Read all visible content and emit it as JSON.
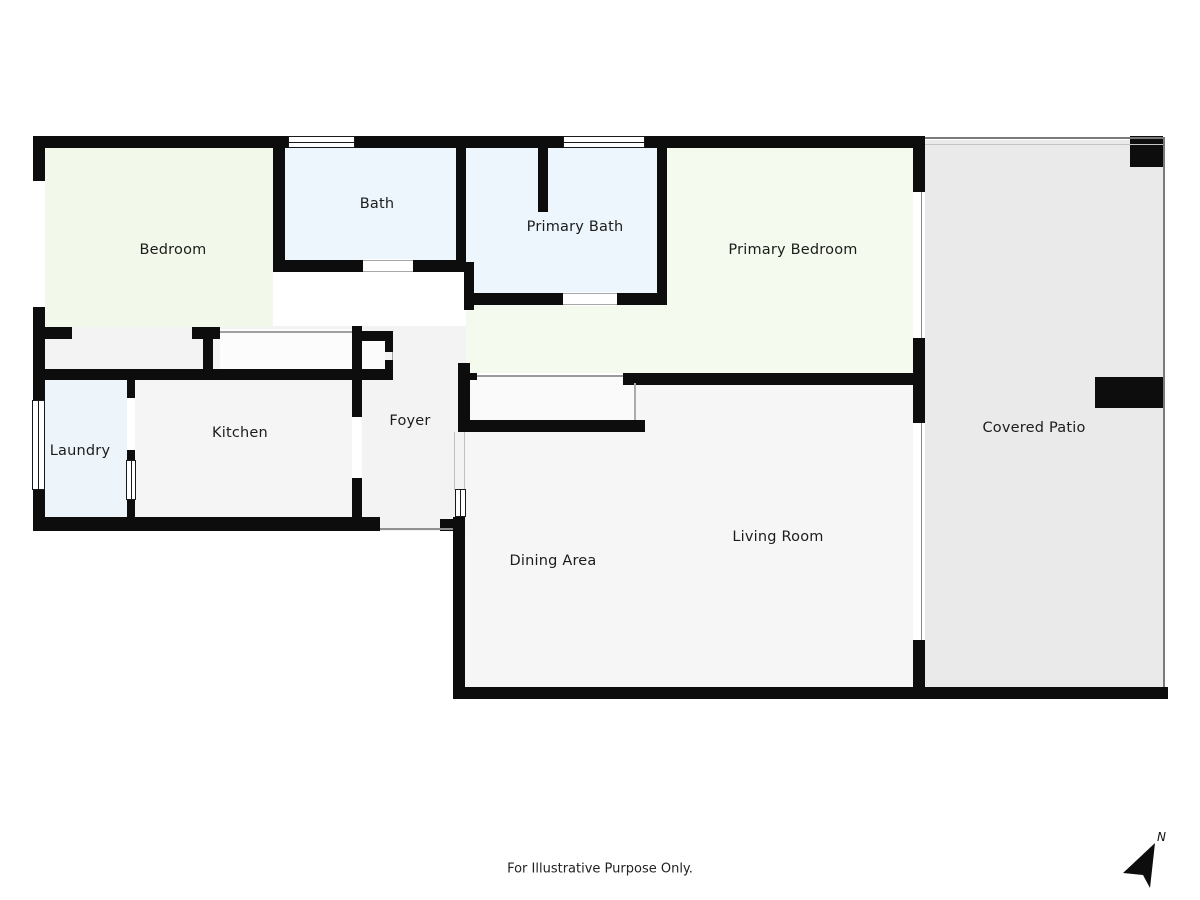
{
  "disclaimer": "For Illustrative Purpose Only.",
  "compass": {
    "label": "N"
  },
  "colors": {
    "wall": "#0d0d0d",
    "background": "#ffffff",
    "patio": "#eaeaea",
    "living_area": "#f6f6f6",
    "hall": "#f3f3f3",
    "kitchen": "#f5f5f5",
    "wet_room_blue": "#edf6fc",
    "bedroom_green": "#f4faee",
    "label_text": "#1c1c1c"
  },
  "rooms": [
    {
      "id": "bedroom",
      "label": "Bedroom",
      "x": 173,
      "y": 250
    },
    {
      "id": "bath",
      "label": "Bath",
      "x": 377,
      "y": 204
    },
    {
      "id": "primary-bath",
      "label": "Primary Bath",
      "x": 575,
      "y": 227
    },
    {
      "id": "primary-bedroom",
      "label": "Primary Bedroom",
      "x": 793,
      "y": 250
    },
    {
      "id": "covered-patio",
      "label": "Covered Patio",
      "x": 1034,
      "y": 428
    },
    {
      "id": "laundry",
      "label": "Laundry",
      "x": 80,
      "y": 451
    },
    {
      "id": "kitchen",
      "label": "Kitchen",
      "x": 240,
      "y": 433
    },
    {
      "id": "foyer",
      "label": "Foyer",
      "x": 410,
      "y": 421
    },
    {
      "id": "dining-area",
      "label": "Dining Area",
      "x": 553,
      "y": 561
    },
    {
      "id": "living-room",
      "label": "Living Room",
      "x": 778,
      "y": 537
    }
  ],
  "fills": [
    {
      "n": "room-fill-covered-patio",
      "x": 925,
      "y": 140,
      "w": 238,
      "h": 547,
      "c": "#eaeaea"
    },
    {
      "n": "room-fill-living-dining",
      "x": 456,
      "y": 383,
      "w": 457,
      "h": 304,
      "c": "#f6f6f6"
    },
    {
      "n": "room-fill-hallway",
      "x": 45,
      "y": 326,
      "w": 421,
      "h": 54,
      "c": "#f3f3f3"
    },
    {
      "n": "room-fill-foyer",
      "x": 362,
      "y": 380,
      "w": 104,
      "h": 151,
      "c": "#f3f3f3"
    },
    {
      "n": "room-fill-kitchen",
      "x": 135,
      "y": 380,
      "w": 217,
      "h": 137,
      "c": "#f5f5f5"
    },
    {
      "n": "room-fill-laundry",
      "x": 45,
      "y": 380,
      "w": 82,
      "h": 137,
      "c": "#edf5fa"
    },
    {
      "n": "room-fill-bedroom",
      "x": 45,
      "y": 148,
      "w": 228,
      "h": 179,
      "c": "#f3f9ea"
    },
    {
      "n": "room-fill-bath",
      "x": 285,
      "y": 148,
      "w": 171,
      "h": 112,
      "c": "#edf6fc"
    },
    {
      "n": "room-fill-primary-bath",
      "x": 466,
      "y": 148,
      "w": 191,
      "h": 145,
      "c": "#edf6fc"
    },
    {
      "n": "room-fill-primary-bedroom",
      "x": 667,
      "y": 148,
      "w": 246,
      "h": 225,
      "c": "#f4faee"
    },
    {
      "n": "room-fill-primary-corridor",
      "x": 466,
      "y": 305,
      "w": 201,
      "h": 68,
      "c": "#f4faee"
    },
    {
      "n": "closet-fill-bedroom",
      "x": 220,
      "y": 329,
      "w": 132,
      "h": 40,
      "c": "#fcfcfc"
    },
    {
      "n": "closet-fill-linen",
      "x": 362,
      "y": 341,
      "w": 23,
      "h": 28,
      "c": "#fbfbfb"
    },
    {
      "n": "closet-fill-entry-nook",
      "x": 470,
      "y": 377,
      "w": 165,
      "h": 43,
      "c": "#fafafa"
    }
  ],
  "walls": [
    {
      "n": "exterior-top-wall",
      "x": 33,
      "y": 136,
      "w": 892,
      "h": 12
    },
    {
      "n": "exterior-left-wall-upper",
      "x": 33,
      "y": 136,
      "w": 12,
      "h": 45
    },
    {
      "n": "exterior-left-wall-mid",
      "x": 33,
      "y": 307,
      "w": 12,
      "h": 93
    },
    {
      "n": "exterior-left-wall-lower",
      "x": 33,
      "y": 490,
      "w": 12,
      "h": 41
    },
    {
      "n": "exterior-bottom-left-wall",
      "x": 33,
      "y": 517,
      "w": 347,
      "h": 14
    },
    {
      "n": "dining-left-wall",
      "x": 453,
      "y": 517,
      "w": 12,
      "h": 182
    },
    {
      "n": "dining-left-corner",
      "x": 440,
      "y": 519,
      "w": 14,
      "h": 12
    },
    {
      "n": "exterior-bottom-wall",
      "x": 453,
      "y": 687,
      "w": 715,
      "h": 12
    },
    {
      "n": "bedroom-bath-wall",
      "x": 273,
      "y": 148,
      "w": 12,
      "h": 124
    },
    {
      "n": "bath-south-wall-left",
      "x": 273,
      "y": 260,
      "w": 90,
      "h": 12
    },
    {
      "n": "bath-south-wall-right",
      "x": 413,
      "y": 260,
      "w": 53,
      "h": 12
    },
    {
      "n": "bath-primarybath-wall",
      "x": 456,
      "y": 148,
      "w": 10,
      "h": 114
    },
    {
      "n": "foyer-primarybath-wall",
      "x": 464,
      "y": 262,
      "w": 10,
      "h": 48
    },
    {
      "n": "primarybath-stub-wall",
      "x": 538,
      "y": 148,
      "w": 10,
      "h": 64
    },
    {
      "n": "primarybath-bedroom-wall",
      "x": 657,
      "y": 148,
      "w": 10,
      "h": 157
    },
    {
      "n": "primarybath-south-left",
      "x": 466,
      "y": 293,
      "w": 97,
      "h": 12
    },
    {
      "n": "primarybath-south-right",
      "x": 617,
      "y": 293,
      "w": 50,
      "h": 12
    },
    {
      "n": "bedroom-south-wall-left",
      "x": 45,
      "y": 327,
      "w": 27,
      "h": 12
    },
    {
      "n": "bedroom-south-wall-mid",
      "x": 192,
      "y": 327,
      "w": 28,
      "h": 12
    },
    {
      "n": "closet-stem-wall",
      "x": 203,
      "y": 339,
      "w": 10,
      "h": 30
    },
    {
      "n": "kitchen-foyer-wall-upper",
      "x": 352,
      "y": 326,
      "w": 10,
      "h": 54
    },
    {
      "n": "linen-closet-top-arm",
      "x": 362,
      "y": 331,
      "w": 31,
      "h": 10
    },
    {
      "n": "linen-closet-jamb-top",
      "x": 385,
      "y": 341,
      "w": 8,
      "h": 11
    },
    {
      "n": "linen-closet-jamb-bottom",
      "x": 385,
      "y": 360,
      "w": 8,
      "h": 11
    },
    {
      "n": "kitchen-north-wall",
      "x": 33,
      "y": 369,
      "w": 360,
      "h": 11
    },
    {
      "n": "kitchen-foyer-stub",
      "x": 352,
      "y": 380,
      "w": 10,
      "h": 37
    },
    {
      "n": "kitchen-foyer-wall-lower",
      "x": 352,
      "y": 478,
      "w": 10,
      "h": 53
    },
    {
      "n": "laundry-kitchen-wall-top",
      "x": 127,
      "y": 380,
      "w": 8,
      "h": 18
    },
    {
      "n": "laundry-kitchen-wall-mid",
      "x": 127,
      "y": 450,
      "w": 8,
      "h": 10
    },
    {
      "n": "laundry-kitchen-wall-low",
      "x": 127,
      "y": 500,
      "w": 8,
      "h": 17
    },
    {
      "n": "nook-left-wall",
      "x": 458,
      "y": 363,
      "w": 12,
      "h": 69
    },
    {
      "n": "nook-left-stub",
      "x": 470,
      "y": 373,
      "w": 7,
      "h": 7
    },
    {
      "n": "nook-bottom-wall",
      "x": 458,
      "y": 420,
      "w": 187,
      "h": 12
    },
    {
      "n": "primarybedroom-south-wall",
      "x": 623,
      "y": 373,
      "w": 302,
      "h": 12
    },
    {
      "n": "primarybedroom-right-top",
      "x": 913,
      "y": 136,
      "w": 12,
      "h": 56
    },
    {
      "n": "primarybedroom-right-mid",
      "x": 913,
      "y": 338,
      "w": 12,
      "h": 85
    },
    {
      "n": "livingroom-right-wall",
      "x": 913,
      "y": 640,
      "w": 12,
      "h": 47
    },
    {
      "n": "patio-corner-post",
      "x": 1130,
      "y": 136,
      "w": 33,
      "h": 31
    },
    {
      "n": "patio-side-block",
      "x": 1095,
      "y": 377,
      "w": 68,
      "h": 31
    }
  ],
  "overlays": [
    {
      "n": "bath-door-opening",
      "x": 363,
      "y": 259,
      "w": 50,
      "h": 14
    },
    {
      "n": "primarybath-door-opening",
      "x": 563,
      "y": 292,
      "w": 54,
      "h": 14
    },
    {
      "n": "primarybedroom-slider",
      "x": 913,
      "y": 192,
      "w": 12,
      "h": 146
    },
    {
      "n": "livingroom-slider",
      "x": 913,
      "y": 423,
      "w": 12,
      "h": 217
    }
  ],
  "lines": [
    {
      "n": "bath-door-line-top",
      "x": 363,
      "y": 260,
      "w": 50,
      "h": 1.2,
      "c": "#a8a8a8"
    },
    {
      "n": "bath-door-line-bottom",
      "x": 363,
      "y": 270.8,
      "w": 50,
      "h": 1.2,
      "c": "#a8a8a8"
    },
    {
      "n": "pbath-door-line-top",
      "x": 563,
      "y": 293,
      "w": 54,
      "h": 1.2,
      "c": "#a8a8a8"
    },
    {
      "n": "pbath-door-line-bottom",
      "x": 563,
      "y": 303.8,
      "w": 54,
      "h": 1.2,
      "c": "#a8a8a8"
    },
    {
      "n": "nook-top-line",
      "x": 477,
      "y": 375,
      "w": 146,
      "h": 1.5,
      "c": "#9a9a9a"
    },
    {
      "n": "nook-right-line",
      "x": 634,
      "y": 383,
      "w": 1.5,
      "h": 37,
      "c": "#ababab"
    },
    {
      "n": "pbed-slider-line",
      "x": 920.5,
      "y": 192,
      "w": 1.5,
      "h": 146,
      "c": "#8a8a8a"
    },
    {
      "n": "living-slider-line",
      "x": 920.5,
      "y": 423,
      "w": 1.5,
      "h": 217,
      "c": "#8a8a8a"
    },
    {
      "n": "foyer-dining-line-left",
      "x": 453.5,
      "y": 432,
      "w": 1.2,
      "h": 58,
      "c": "#c0c0c0"
    },
    {
      "n": "foyer-dining-line-right",
      "x": 464,
      "y": 432,
      "w": 1.2,
      "h": 58,
      "c": "#c0c0c0"
    },
    {
      "n": "entry-door-line",
      "x": 380,
      "y": 528,
      "w": 73,
      "h": 1.5,
      "c": "#909090"
    },
    {
      "n": "bedroom-closet-line",
      "x": 220,
      "y": 331,
      "w": 132,
      "h": 1.5,
      "c": "#a0a0a0"
    },
    {
      "n": "linen-door-line",
      "x": 391.5,
      "y": 352,
      "w": 1.5,
      "h": 8,
      "c": "#a0a0a0"
    },
    {
      "n": "patio-top-line-outer",
      "x": 925,
      "y": 137,
      "w": 240,
      "h": 1.5,
      "c": "#7a7a7a"
    },
    {
      "n": "patio-top-line-inner",
      "x": 925,
      "y": 143.5,
      "w": 240,
      "h": 1,
      "c": "#c4c4c4"
    },
    {
      "n": "patio-right-line",
      "x": 1163,
      "y": 137,
      "w": 1.5,
      "h": 550,
      "c": "#7a7a7a"
    }
  ],
  "windows": [
    {
      "n": "bath-window",
      "x": 288,
      "y": 136,
      "w": 67,
      "h": 12,
      "o": "h"
    },
    {
      "n": "primarybath-window",
      "x": 563,
      "y": 136,
      "w": 82,
      "h": 12,
      "o": "h"
    },
    {
      "n": "laundry-window",
      "x": 32,
      "y": 400,
      "w": 13,
      "h": 90,
      "o": "v"
    },
    {
      "n": "laundry-kitchen-window",
      "x": 126,
      "y": 460,
      "w": 10,
      "h": 40,
      "o": "v"
    },
    {
      "n": "foyer-dining-window",
      "x": 455,
      "y": 489,
      "w": 11,
      "h": 28,
      "o": "v"
    }
  ]
}
